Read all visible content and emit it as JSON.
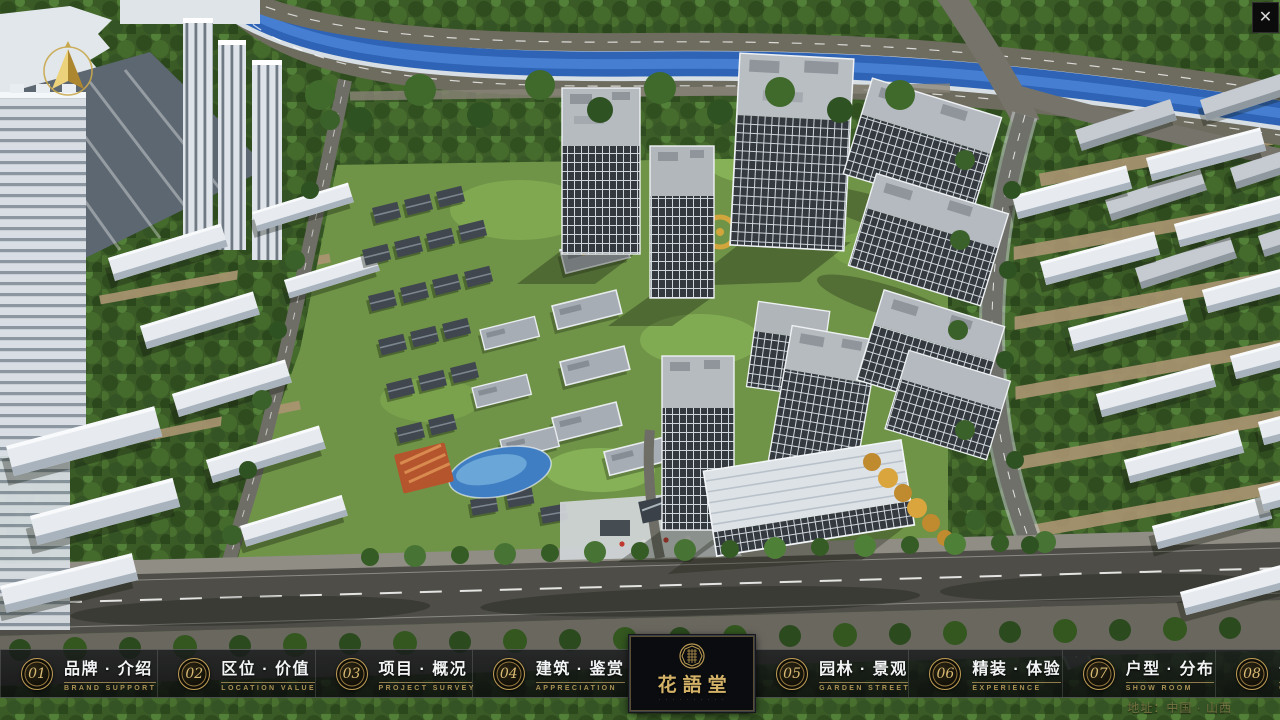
{
  "app": {
    "close_glyph": "✕"
  },
  "nav": {
    "items": [
      {
        "num": "01",
        "label": "品牌 · 介绍",
        "caption": "BRAND SUPPORT"
      },
      {
        "num": "02",
        "label": "区位 · 价值",
        "caption": "LOCATION VALUE"
      },
      {
        "num": "03",
        "label": "项目 · 概况",
        "caption": "PROJECT SURVEY"
      },
      {
        "num": "04",
        "label": "建筑 · 鉴赏",
        "caption": "APPRECIATION"
      },
      {
        "num": "05",
        "label": "园林 · 景观",
        "caption": "GARDEN STREET"
      },
      {
        "num": "06",
        "label": "精装 · 体验",
        "caption": "EXPERIENCE"
      },
      {
        "num": "07",
        "label": "户型 · 分布",
        "caption": "SHOW ROOM"
      },
      {
        "num": "08",
        "label": "一房 · 一景",
        "caption": "COMMUNITY"
      }
    ]
  },
  "logo": {
    "title": "花語堂",
    "caption": "· · · · · · · · · ·"
  },
  "footer": {
    "address": "地址：中国 · 山西"
  },
  "colors": {
    "gold": "#c9a85c",
    "bar_bg": "rgba(10,12,15,0.82)",
    "river": "#2e63b5"
  }
}
